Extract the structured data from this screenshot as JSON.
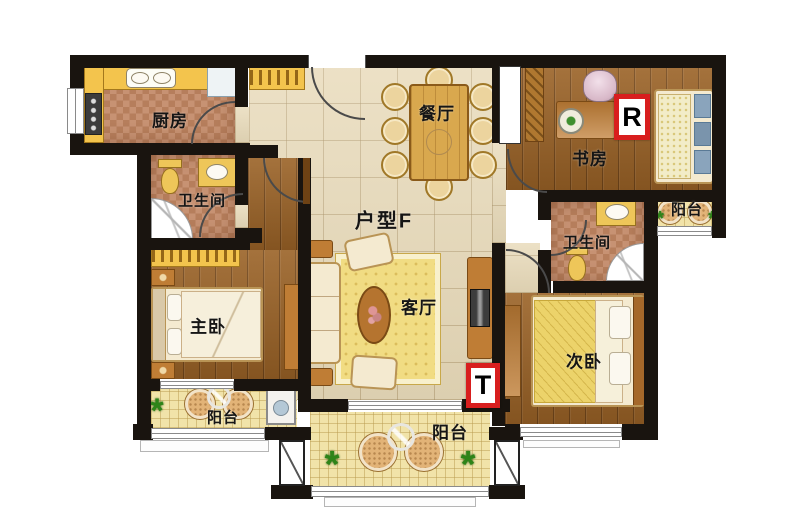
{
  "floorplan": {
    "unit_label": "户型F",
    "rooms": {
      "kitchen": "厨房",
      "dining": "餐厅",
      "study": "书房",
      "bathroom_left": "卫生间",
      "bathroom_right": "卫生间",
      "master_bedroom": "主卧",
      "living_room": "客厅",
      "second_bedroom": "次卧",
      "balcony_left": "阳台",
      "balcony_bottom": "阳台",
      "balcony_right": "阳台"
    },
    "markers": {
      "r": "R",
      "t": "T"
    },
    "icons": {
      "plant": "*"
    },
    "colors": {
      "wall": "#19140f",
      "marker_border": "#d81e1e",
      "floor_tile": "#e8dab9",
      "wood_floor": "#9a6226",
      "cabinet_yellow": "#f3c44d"
    }
  }
}
